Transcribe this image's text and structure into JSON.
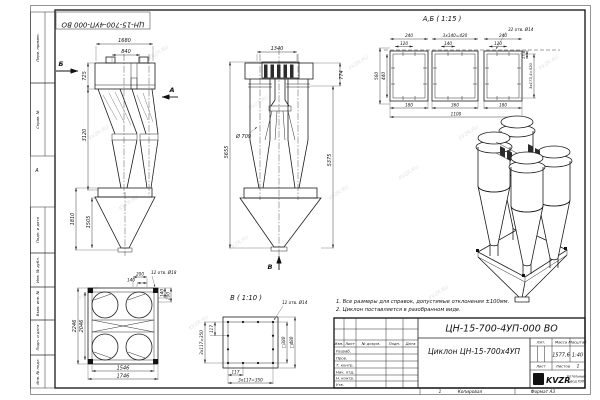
{
  "sheet": {
    "watermark": "KVZR.RU",
    "zone_marker": "А",
    "margin_labels": {
      "perv_primen": "Перв. примен.",
      "sprav_no": "Справ. №",
      "podp_data_1": "Подп. и дата",
      "inv_dubl": "Инв. № дубл.",
      "vzam_inv": "Взам. инв. №",
      "podp_data_2": "Подп. и дата",
      "inv_podl": "Инв. № подл."
    },
    "footer": {
      "num": "1",
      "copy": "Копировал",
      "format": "Формат А3"
    }
  },
  "notes": {
    "line1": "1. Все размеры для справок, допустимые отклонения ±100мм.",
    "line2": "2. Циклон поставляется в разобранном виде."
  },
  "front_view": {
    "label_b": "Б",
    "label_a": "А",
    "dim_1680": "1680",
    "dim_840": "840",
    "dim_725": "725",
    "dim_3120": "3120",
    "dim_1810": "1810",
    "dim_1505": "1505"
  },
  "side_view": {
    "label_v": "В",
    "dim_1340": "1340",
    "dim_774": "774",
    "dia_709": "Ø 709",
    "dim_5375": "5375",
    "dim_5655": "5655"
  },
  "section_ab": {
    "title": "А,Б ( 1:15 )",
    "holes": "32 отв. Ø14",
    "dim_240_l": "240",
    "dim_3x140": "3х140=420",
    "dim_240_r": "240",
    "dim_120_l": "120",
    "dim_140": "140",
    "dim_120_r": "120",
    "dim_560": "560",
    "dim_440": "440",
    "dim_180_l": "180",
    "dim_360": "360",
    "dim_180_r": "180",
    "dim_1100": "1100",
    "dim_178": "17,8",
    "dim_3x173": "3х173,4=520"
  },
  "top_view": {
    "holes": "12 отв. Ø18",
    "dim_200_t": "200",
    "dim_140_t": "140",
    "dim_140_r": "140",
    "dim_200_r": "200",
    "dim_2246": "2246",
    "dim_2046": "2046",
    "dim_1546": "1546",
    "dim_1746": "1746"
  },
  "flange_view": {
    "title": "В ( 1:10 )",
    "holes": "12 отв. Ø14",
    "dim_3x117_l": "3х117=350",
    "dim_117_l": "117",
    "dim_117_b": "117",
    "dim_3x117_b": "3х117=350",
    "dim_sq380": "□380",
    "dim_sq480": "□480"
  },
  "title_block": {
    "doc_number": "ЦН-15-700-4УП-000 ВО",
    "name": "Циклон ЦН-15-700х4УП",
    "col_izm": "Изм.",
    "col_list": "Лист",
    "col_doc": "№ докум.",
    "col_podp": "Подп.",
    "col_data": "Дата",
    "rows": {
      "razrab": "Разраб.",
      "prov": "Пров.",
      "t_kontr": "Т. контр.",
      "nach": "Нач. отд.",
      "n_kontr": "Н. контр.",
      "utv": "Утв."
    },
    "lit_label": "Лит.",
    "mass_label": "Масса",
    "scale_label": "Масштаб",
    "mass_value": "1577,6",
    "scale_value": "1:40",
    "list_label": "Лист",
    "listov_label": "Листов",
    "listov_value": "1",
    "logo_wave": "≋",
    "logo": "KVZR",
    "logo_caption1": "Котельный",
    "logo_caption2": "завод РЭП"
  }
}
